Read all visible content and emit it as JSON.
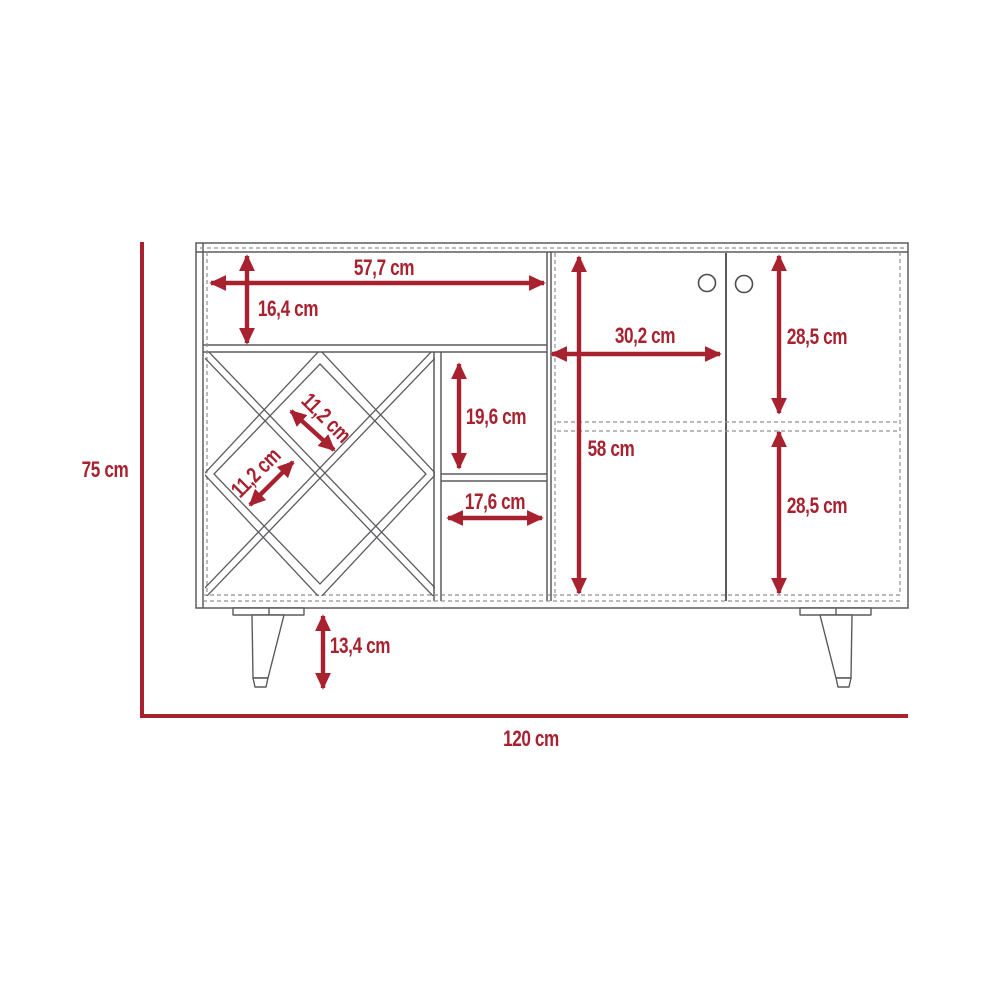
{
  "diagram_type": "furniture dimension drawing (bar cabinet / sideboard with wine rack, two doors and tapered legs)",
  "colors": {
    "dimension_red": "#A8212F",
    "line_gray": "#5B5B5F",
    "dashed_gray": "#8F9094"
  },
  "overall": {
    "height_label": "75 cm",
    "width_label": "120 cm"
  },
  "dims": {
    "top_shelf_width": "57,7 cm",
    "top_shelf_height": "16,4 cm",
    "door_width": "30,2 cm",
    "interior_height": "58 cm",
    "upper_door_height": "28,5 cm",
    "lower_door_height": "28,5 cm",
    "cubby_height": "19,6 cm",
    "cubby_width": "17,6 cm",
    "rack_cell_upper": "11,2 cm",
    "rack_cell_lower": "11,2 cm",
    "leg_height": "13,4 cm"
  }
}
